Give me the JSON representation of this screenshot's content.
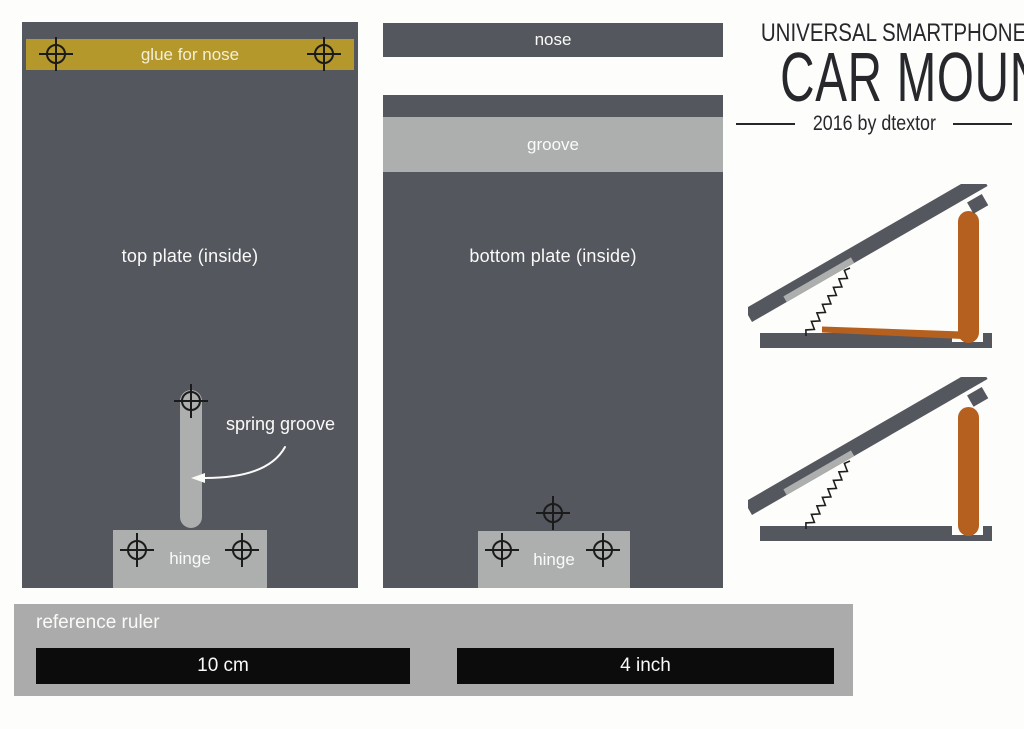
{
  "title": {
    "line1": "UNIVERSAL SMARTPHONE",
    "line2": "CAR MOUNT",
    "byline": "2016 by dtextor"
  },
  "top_plate": {
    "glue_label": "glue for nose",
    "label": "top plate (inside)",
    "spring_groove_label": "spring groove",
    "hinge_label": "hinge"
  },
  "bottom_plate": {
    "nose_label": "nose",
    "groove_label": "groove",
    "label": "bottom plate (inside)",
    "hinge_label": "hinge"
  },
  "ruler": {
    "label": "reference ruler",
    "metric_bar": "10 cm",
    "imperial_bar": "4 inch"
  },
  "colors": {
    "plate_dark": "#54575e",
    "accent_gold": "#b5982b",
    "part_gray": "#adafae",
    "nose_orange": "#b5601f",
    "ruler_gray": "#ababab",
    "bar_black": "#0c0c0c",
    "title_ink": "#26282b",
    "cream_text": "#f3eed7",
    "white_text": "#fafaf8",
    "mark_ink": "#1b1b1b"
  }
}
